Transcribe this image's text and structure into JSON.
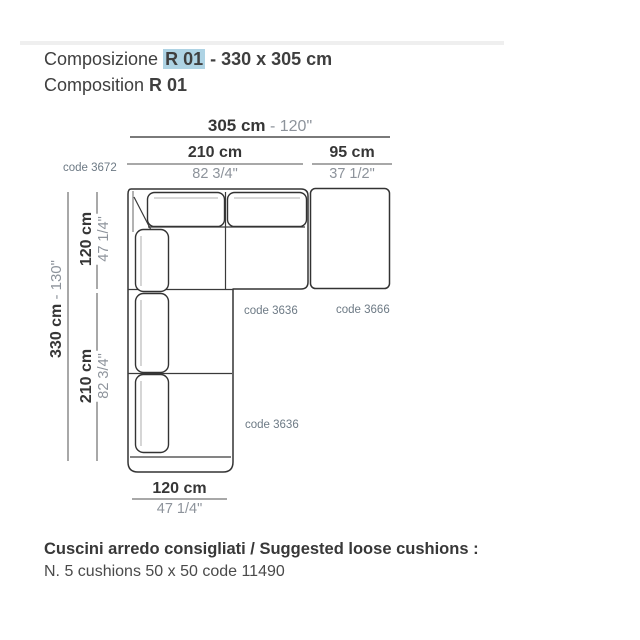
{
  "header": {
    "title_prefix": "Composizione ",
    "composition_code": "R 01",
    "title_suffix": " - 330 x 305 cm",
    "subtitle_prefix": "Composition ",
    "subtitle_code": "R 01",
    "highlight_color": "#aed3e4"
  },
  "dimensions": {
    "total_width_cm": "305 cm",
    "total_width_in": " - 120\"",
    "seat_width_cm": "210 cm",
    "seat_width_in": "82 3/4\"",
    "ottoman_width_cm": "95 cm",
    "ottoman_width_in": "37 1/2\"",
    "total_depth_cm": "330 cm",
    "total_depth_in": " - 130\"",
    "top_depth_cm": "120 cm",
    "top_depth_in": "47 1/4\"",
    "left_seat_cm": "210 cm",
    "left_seat_in": "82 3/4\"",
    "bottom_width_cm": "120 cm",
    "bottom_width_in": "47 1/4\""
  },
  "codes": {
    "corner_element": "code 3672",
    "top_seat_element": "code 3636",
    "ottoman_element": "code 3666",
    "left_seat_element": "code 3636"
  },
  "footer": {
    "headline": "Cuscini arredo consigliati / Suggested loose cushions :",
    "detail": "N. 5 cushions 50 x 50 code 11490"
  },
  "colors": {
    "text_dark": "#3a3a3a",
    "text_light": "#8d939b",
    "code_text": "#6d7a85",
    "dim_line": "#8c8c8c",
    "outline": "#333333",
    "highlight": "#aed3e4"
  }
}
